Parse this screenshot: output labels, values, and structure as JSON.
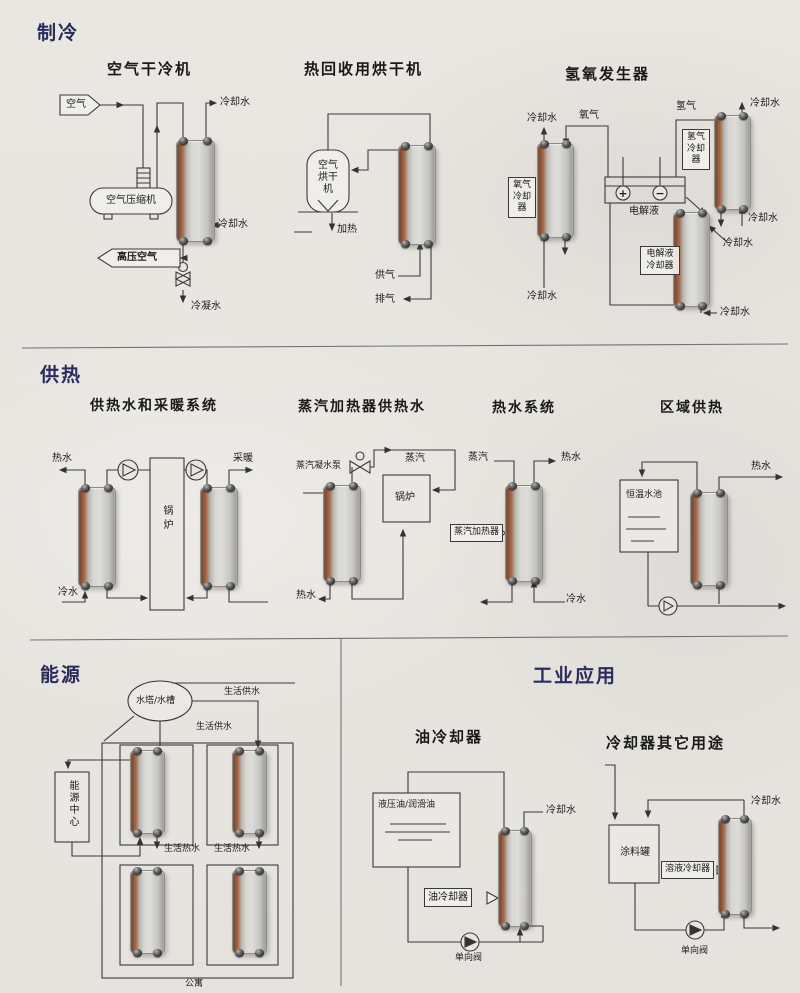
{
  "sections": {
    "refrigeration": {
      "header": "制冷",
      "air_dry_cooler": {
        "title": "空气干冷机",
        "labels": {
          "air": "空气",
          "compressor": "空气压缩机",
          "cooling_water_out": "冷却水",
          "cooling_water_in": "冷却水",
          "high_pressure_air": "高压空气",
          "condensate": "冷凝水"
        }
      },
      "heat_recovery_dryer": {
        "title": "热回收用烘干机",
        "labels": {
          "air_dryer": "空气烘干机",
          "heating": "加热",
          "supply_gas": "供气",
          "exhaust_gas": "排气"
        }
      },
      "hydrogen_oxygen_generator": {
        "title": "氢氧发生器",
        "labels": {
          "cw_left_top": "冷却水",
          "oxygen": "氧气",
          "oxygen_cooler": "氧气冷却器",
          "hydrogen": "氢气",
          "hydrogen_cooler": "氢气冷却器",
          "cw_right_top": "冷却水",
          "cw_right_mid": "冷却水",
          "electrolyte": "电解液",
          "electrolyte_cooler": "电解液冷却器",
          "cw_center": "冷却水",
          "cw_bottom": "冷却水",
          "cw_left_bottom": "冷却水",
          "anode_plus": "+",
          "cathode_minus": "−"
        }
      }
    },
    "heating": {
      "header": "供热",
      "hot_water_and_heating_system": {
        "title": "供热水和采暖系统",
        "labels": {
          "hot_water": "热水",
          "heating_supply": "采暖",
          "boiler": "锅炉",
          "cold_water": "冷水"
        }
      },
      "steam_heater_hot_water": {
        "title": "蒸汽加热器供热水",
        "labels": {
          "steam_condensate_pump": "蒸汽凝水泵",
          "steam": "蒸汽",
          "boiler": "锅炉",
          "hot_water": "热水"
        }
      },
      "hot_water_system": {
        "title": "热水系统",
        "labels": {
          "steam": "蒸汽",
          "hot_water": "热水",
          "steam_heater": "蒸汽加热器",
          "cold_water": "冷水"
        }
      },
      "district_heating": {
        "title": "区域供热",
        "labels": {
          "thermostatic_pool": "恒温水池",
          "hot_water": "热水"
        }
      }
    },
    "energy": {
      "header": "能源",
      "labels": {
        "water_tower": "水塔/水槽",
        "domestic_supply_1": "生活供水",
        "domestic_supply_2": "生活供水",
        "energy_center": "能源中心",
        "domestic_hot_water_1": "生活热水",
        "domestic_hot_water_2": "生活热水",
        "apartment": "公寓"
      }
    },
    "industrial": {
      "header": "工业应用",
      "oil_cooler": {
        "title": "油冷却器",
        "labels": {
          "oil": "液压油/润滑油",
          "cooling_water": "冷却水",
          "oil_cooler": "油冷却器",
          "check_valve": "单向阀"
        }
      },
      "cooler_other_uses": {
        "title": "冷却器其它用途",
        "labels": {
          "paint_tank": "涂料罐",
          "solution_cooler": "溶液冷却器",
          "cooling_water": "冷却水",
          "check_valve": "单向阀"
        }
      }
    }
  },
  "colors": {
    "header_navy": "#2b2b5e",
    "line": "#3a3a3a",
    "paper": "#e9e6e1",
    "hx_copper": "#8f583e"
  }
}
